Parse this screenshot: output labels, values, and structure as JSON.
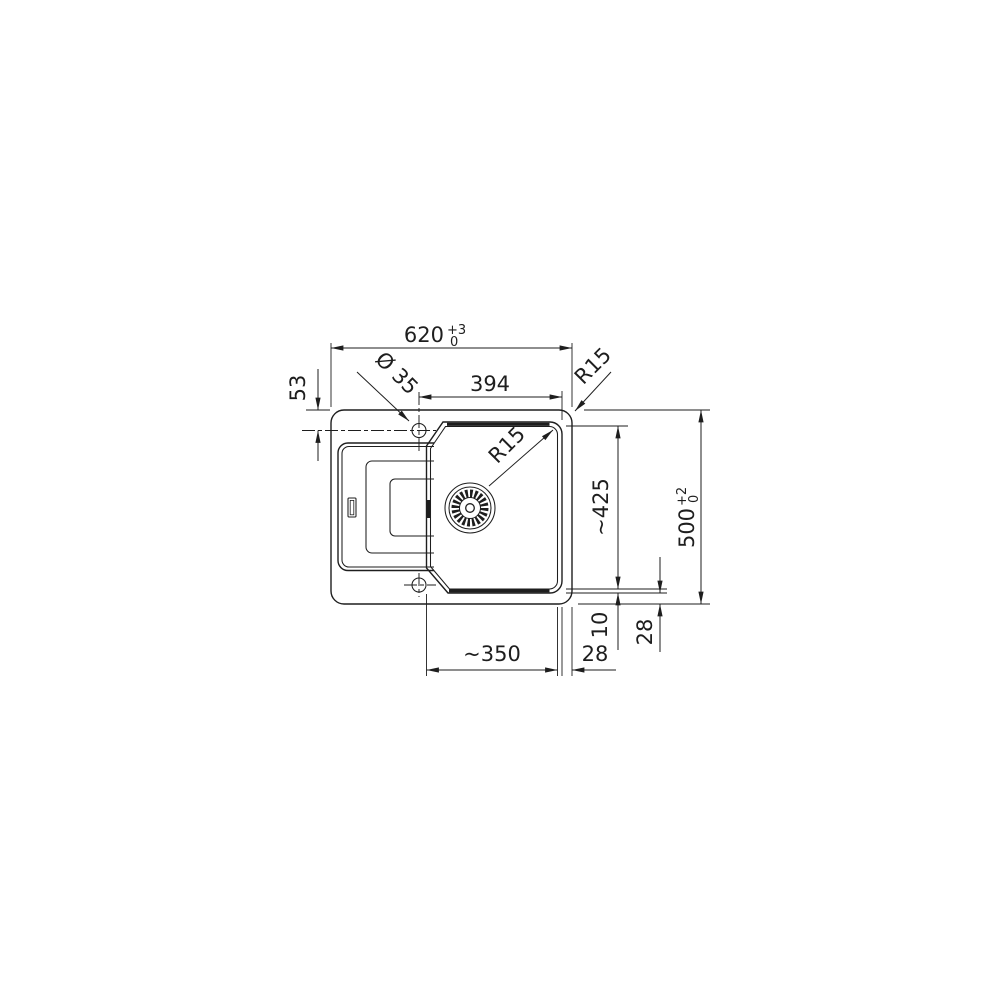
{
  "drawing": {
    "type": "sink-installation-technical-drawing",
    "colors": {
      "line": "#1e1e1e",
      "background": "#ffffff"
    },
    "dimensions": {
      "overall_width": {
        "value": "620",
        "tol_plus": "+3",
        "tol_minus": "0"
      },
      "bowl_width_top": "394",
      "faucet_offset": "53",
      "faucet_hole_diameter": "Ø 35",
      "corner_radius_outer": "R15",
      "corner_radius_bowl": "R15",
      "bowl_depth": "~425",
      "overall_height": {
        "value": "500",
        "tol_plus": "+2",
        "tol_minus": "0"
      },
      "rim_width": "10",
      "edge_offset_vertical": "28",
      "bowl_width_bottom": "~350",
      "edge_offset_horizontal": "28"
    }
  }
}
